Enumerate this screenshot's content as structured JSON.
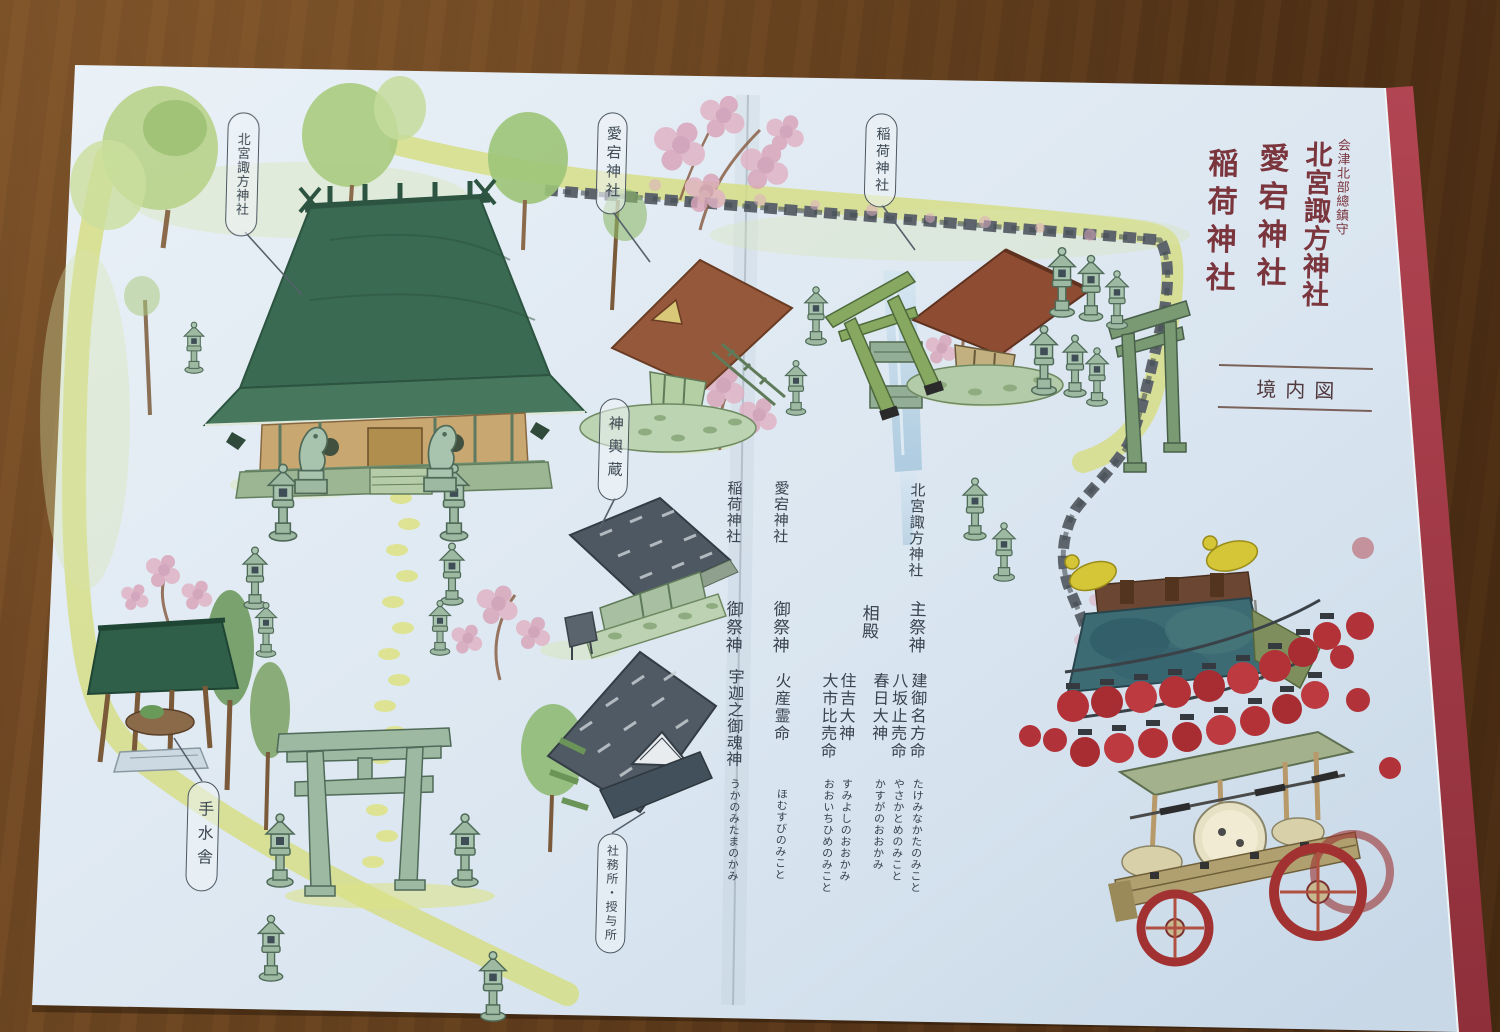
{
  "palette": {
    "table_wood": "#6b4521",
    "paper": "#dfe9f2",
    "cover_edge_red": "#a83a46",
    "title_ink": "#7b353d",
    "text_ink": "#39434f",
    "path_yellow": "#d6dd80",
    "main_roof_green": "#3a6a52",
    "lantern_red": "#b23238"
  },
  "cover": {
    "dedication": "会津北部總鎮守",
    "shrine_primary": "北宮諏方神社",
    "shrine_secondary": "愛宕神社",
    "shrine_tertiary": "稲荷神社",
    "caption": "境内図"
  },
  "map_labels": {
    "main_shrine": "北宮諏方神社",
    "atago_shrine": "愛宕神社",
    "inari_shrine": "稲荷神社",
    "mikoshi_storehouse": "神輿蔵",
    "temizuya": "手水舎",
    "shrine_office": "社務所・授与所"
  },
  "enshrined": {
    "main": {
      "shrine": "北宮諏方神社",
      "role_primary": "主祭神",
      "primary": [
        {
          "name": "建御名方命",
          "kana": "たけみなかたのみこと"
        },
        {
          "name": "八坂止売命",
          "kana": "やさかとめのみこと"
        }
      ],
      "role_co": "相殿",
      "co": [
        {
          "name": "春日大神",
          "kana": "かすがのおおかみ"
        },
        {
          "name": "住吉大神",
          "kana": "すみよしのおおかみ"
        },
        {
          "name": "大市比売命",
          "kana": "おおいちひめのみこと"
        }
      ]
    },
    "atago": {
      "shrine": "愛宕神社",
      "role": "御祭神",
      "name": "火産霊命",
      "kana": "ほむすびのみこと"
    },
    "inari": {
      "shrine": "稲荷神社",
      "role": "御祭神",
      "name": "宇迦之御魂神",
      "kana": "うかのみたまのかみ"
    }
  }
}
